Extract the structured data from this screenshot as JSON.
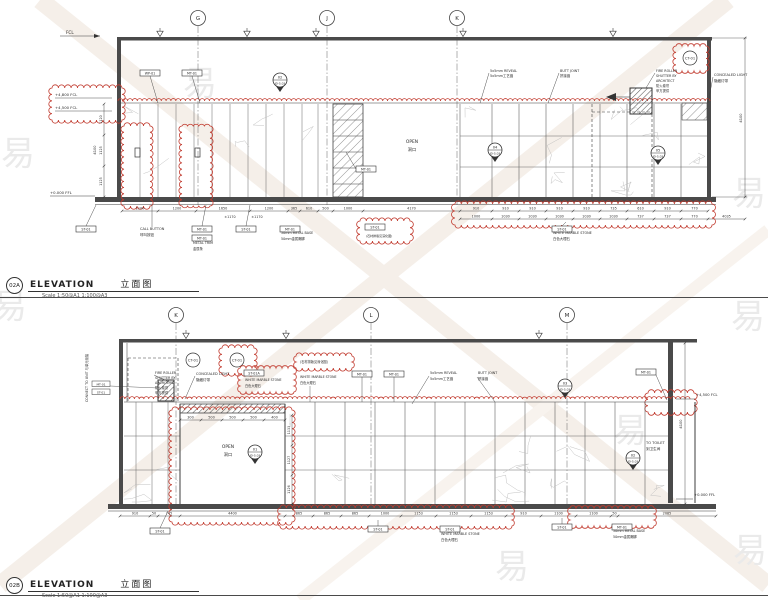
{
  "colors": {
    "red": "#c13a2e",
    "line": "#3c3c3c",
    "wall": "#4a4a4a"
  },
  "watermark": {
    "glyph": "易"
  },
  "title_a": {
    "tag": "02A",
    "title": "ELEVATION",
    "title_cn": "立面图",
    "scale": "Scale 1:50@A1  1:100@A3"
  },
  "title_b": {
    "tag": "02B",
    "title": "ELEVATION",
    "title_cn": "立面图",
    "scale": "Scale 1:50@A1  1:100@A3"
  },
  "labels": {
    "st01": "ST-01",
    "st01a": "ST-01A",
    "mt01": "MT-01",
    "wp01": "WP-01",
    "ct01": "CT-01",
    "call_button_en": "CALL BUTTON",
    "call_button_cn": "呼叫按钮",
    "metal_trim_en": "METAL TRIM",
    "metal_trim_cn": "金属条",
    "metal_base_en": "50mm METAL BASE",
    "metal_base_cn": "50mm金属踢脚",
    "marble_en": "WHITE MARBLE STONE",
    "marble_cn": "白色大理石",
    "reveal_en": "5x5mm REVEAL",
    "reveal_cn": "5x5mm工艺缝",
    "butt_en": "BUTT JOINT",
    "butt_cn": "拼接缝",
    "shutter1": "FIRE ROLLER",
    "shutter2": "SHUTTER BY",
    "shutter3": "ARCHITECT",
    "shutter_cn1": "防火卷帘",
    "shutter_cn2": "甲方提供",
    "concealed_en": "CONCEALED LIGHT",
    "concealed_cn": "隐藏灯带",
    "open_en": "OPEN",
    "open_cn": "洞口",
    "toilet_en": "TO TOILET",
    "toilet_cn": "到卫生间",
    "stone_note": "(石材排版见深化图)",
    "connect_v": "CONNECT TO UNIT 与单元衔接"
  },
  "levels": {
    "fcl": "FCL",
    "l4800": "+4,800 FCL",
    "l4500": "+4,500 FCL",
    "l0": "+0.000 FFL"
  },
  "keynotes": {
    "k01": {
      "num": "01",
      "sheet": "ID-5.03"
    },
    "k02": {
      "num": "02",
      "sheet": "ID-5.03"
    },
    "k03": {
      "num": "03",
      "sheet": "ID-5.03"
    },
    "k04": {
      "num": "04",
      "sheet": "ID-5.03"
    },
    "k05": {
      "num": "05",
      "sheet": "ID-5.03"
    }
  },
  "drawing_a": {
    "grid": [
      "G",
      "J",
      "K"
    ],
    "dims_row1": [
      "1100",
      "1200",
      "1650",
      "1200",
      "365",
      "610",
      "500",
      "1000",
      "4170",
      "910",
      "910",
      "910",
      "910",
      "910",
      "735",
      "610",
      "910",
      "770"
    ],
    "dims_row2": [
      "1000",
      "1030",
      "1030",
      "1030",
      "1030",
      "1030",
      "737",
      "737",
      "770",
      "4035"
    ],
    "dims_extra": [
      "±1170",
      "±1170"
    ],
    "dims_left": [
      "1120",
      "1125",
      "1125"
    ],
    "dim_total": "4100"
  },
  "drawing_b": {
    "grid": [
      "K",
      "L",
      "M"
    ],
    "dims_row1": [
      "910",
      "50",
      "745",
      "4400",
      "865",
      "865",
      "865",
      "1000",
      "1153",
      "1153",
      "1153",
      "910",
      "1100",
      "1100",
      "50",
      "2085"
    ],
    "dims_lintel": [
      "300",
      "500",
      "500",
      "500",
      "400"
    ],
    "dims_right": [
      "1133",
      "1127",
      "1126"
    ],
    "dim_total": "4100"
  }
}
